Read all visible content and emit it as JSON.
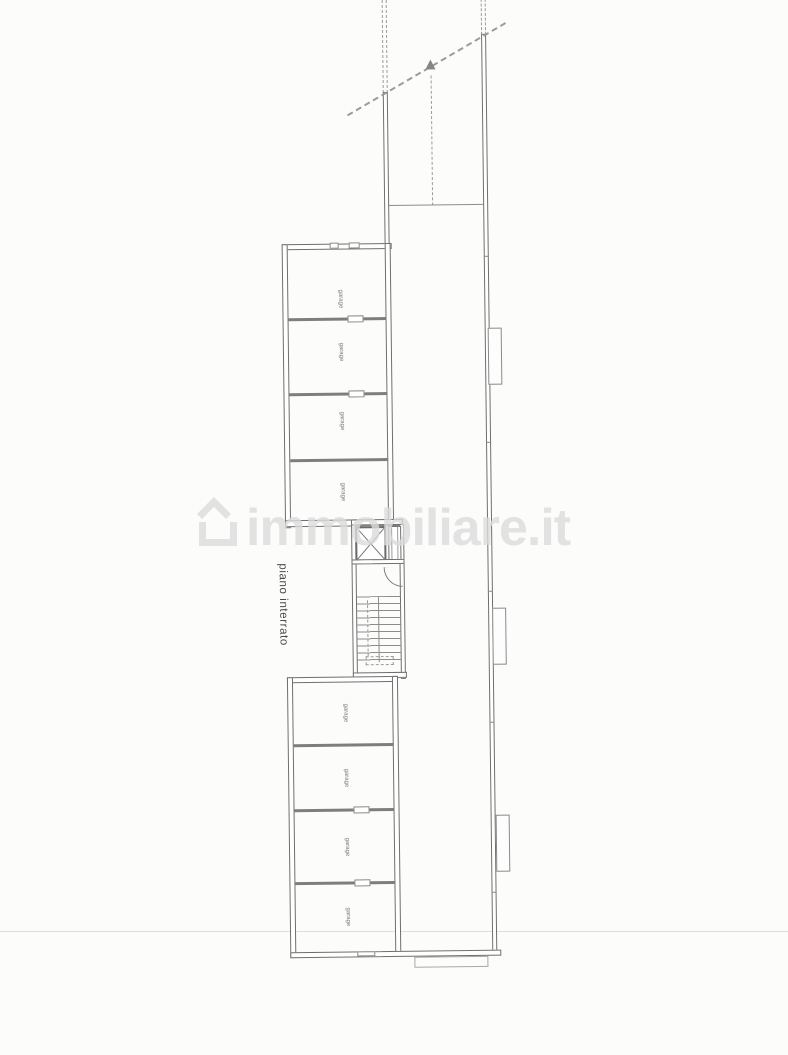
{
  "page": {
    "kind": "architectural floor plan scan",
    "background": "#fcfcfb"
  },
  "floor": {
    "label": "piano interrato"
  },
  "watermark": {
    "text": "immobiliare.it",
    "icon": "house-icon",
    "color": "#dcdcdc"
  },
  "rooms": {
    "upper": [
      {
        "label": "garage"
      },
      {
        "label": "garage"
      },
      {
        "label": "garage"
      },
      {
        "label": "garage"
      }
    ],
    "lower": [
      {
        "label": "garage"
      },
      {
        "label": "garage"
      },
      {
        "label": "garage"
      },
      {
        "label": "garage"
      }
    ]
  },
  "core": {
    "elevator": "elevator-shaft",
    "stairs": "staircase",
    "duct": "duct-shaft"
  },
  "ramp": {
    "direction_arrow": "up-arrow-icon"
  },
  "colors": {
    "line": "#6f6f6f",
    "divider": "#7e7e7e",
    "dashed": "#9b9b9b",
    "faint_line": "#dedede",
    "text": "#4a4a4a",
    "watermark": "#dcdcdc"
  }
}
